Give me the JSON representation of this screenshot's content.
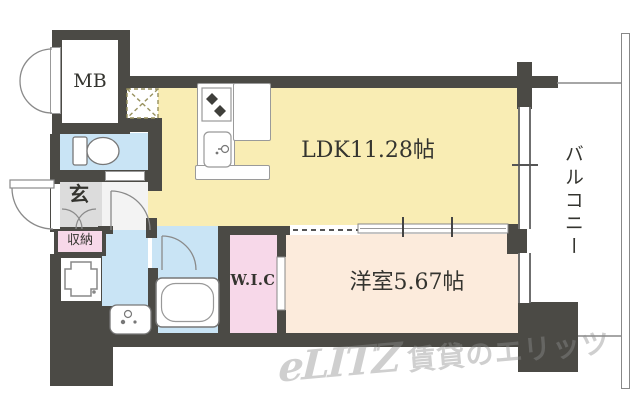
{
  "floorplan": {
    "rooms": {
      "mb": {
        "label": "MB"
      },
      "ldk": {
        "label": "LDK11.28帖",
        "color": "#f9edb4"
      },
      "bedroom": {
        "label": "洋室5.67帖",
        "color": "#fcebdc"
      },
      "wic": {
        "label": "W.I.C",
        "color": "#f7d8e9"
      },
      "entrance": {
        "label": "玄",
        "color": "#dcdcdc"
      },
      "storage": {
        "label": "収納",
        "color": "#f7d8e9"
      },
      "balcony": {
        "label": "バルコニー"
      },
      "toilet": {
        "color": "#c9e4f5"
      },
      "washroom": {
        "color": "#c9e4f5"
      },
      "bathroom": {
        "color": "#c9e4f5"
      }
    },
    "colors": {
      "wall": "#4b4a45",
      "fixture_outline": "#8a8a8a",
      "label_text": "#34342f",
      "watermark": "#c6c6c6"
    },
    "icons": [
      "toilet-icon",
      "washbasin-icon",
      "bathtub-icon",
      "stove-icon",
      "kitchen-sink-icon",
      "elevator-icon",
      "door-swing-arc-icon",
      "sliding-door-icon",
      "window-icon",
      "hatch-icon"
    ],
    "watermark": {
      "logo": "eLITZ",
      "text": "賃貸のエリッツ"
    }
  }
}
